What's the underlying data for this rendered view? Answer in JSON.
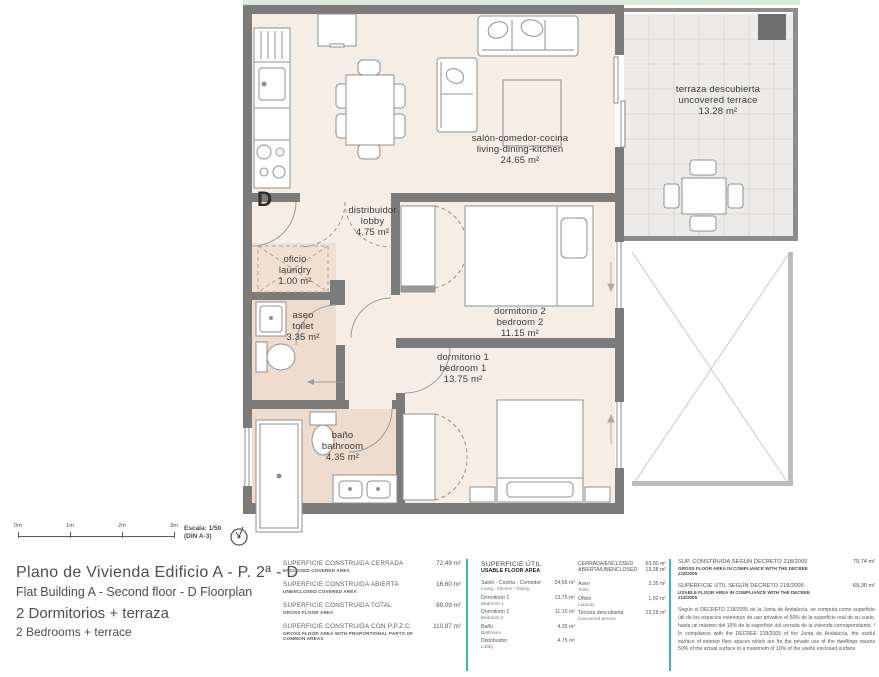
{
  "colors": {
    "accent_teal": "#45b2a6",
    "wall_gray": "#7b7b7b",
    "floor_cream": "#f6eee6",
    "wet_floor": "#f0e0d3",
    "terrace_gray": "#ecebe9"
  },
  "plan": {
    "unit_letter": "D",
    "rooms": [
      {
        "id": "living",
        "es": "salón-comedor-cocina",
        "en": "living-dining-kitchen",
        "area": "24.65 m²"
      },
      {
        "id": "terrace",
        "es": "terraza descubierta",
        "en": "uncovered terrace",
        "area": "13.28 m²"
      },
      {
        "id": "lobby",
        "es": "distribuidor",
        "en": "lobby",
        "area": "4.75 m²"
      },
      {
        "id": "laundry",
        "es": "oficio",
        "en": "laundry",
        "area": "1.00 m²"
      },
      {
        "id": "toilet",
        "es": "aseo",
        "en": "toilet",
        "area": "3.35 m²"
      },
      {
        "id": "bedroom2",
        "es": "dormitorio 2",
        "en": "bedroom 2",
        "area": "11.15 m²"
      },
      {
        "id": "bedroom1",
        "es": "dormitorio 1",
        "en": "bedroom 1",
        "area": "13.75 m²"
      },
      {
        "id": "bathroom",
        "es": "baño",
        "en": "bathroom",
        "area": "4.35 m²"
      }
    ]
  },
  "scalebar": {
    "ticks": [
      "0m",
      "1m",
      "2m",
      "3m"
    ],
    "scale": "Escala: 1/50",
    "sheet": "(DIN A-3)"
  },
  "title_block": {
    "es_line1": "Plano de Vivienda Edificio A - P. 2ª - D",
    "en_line1": "Flat Building A - Second floor - D  Floorplan",
    "es_line2": "2 Dormitorios + terraza",
    "en_line2": "2 Bedrooms + terrace"
  },
  "built_areas": {
    "rows": [
      {
        "es": "SUPERFICIE CONSTRUIDA CERRADA",
        "en": "ENCLOSED COVERED AREA",
        "value": "72,49 m²"
      },
      {
        "es": "SUPERFICIE CONSTRUIDA ABIERTA",
        "en": "UNENCLOSED COVERED AREA",
        "value": "16,60 m²"
      },
      {
        "es": "SUPERFICIE CONSTRUIDA TOTAL",
        "en": "GROSS FLOOR AREA",
        "value": "89,09 m²"
      },
      {
        "es": "SUPERFICIE CONSTRUIDA CON P.P.Z.C.",
        "en": "GROSS FLOOR AREA WITH PROPORTIONAL PARTS OF COMMON AREAS",
        "value": "110,87 m²"
      }
    ]
  },
  "usable_areas": {
    "title_es": "SUPERFICIE ÚTIL",
    "title_en": "USABLE FLOOR AREA",
    "rooms_left": [
      {
        "es": "Salón - Cocina - Comedor",
        "en": "Living - Kitchen - Dining",
        "value": "24,65 m²"
      },
      {
        "es": "Dormitorio 1",
        "en": "Bedroom 1",
        "value": "13,75 m²"
      },
      {
        "es": "Dormitorio 2",
        "en": "Bedroom 2",
        "value": "11,15 m²"
      },
      {
        "es": "Baño",
        "en": "Bathroom",
        "value": "4,35 m²"
      },
      {
        "es": "Distribuidor",
        "en": "Lobby",
        "value": "4,75 m²"
      }
    ],
    "summary": [
      {
        "label": "CERRADA/ENCLOSED",
        "value": "63,00 m²"
      },
      {
        "label": "ABIERTA/UNENCLOSED",
        "value": "13,28 m²"
      }
    ],
    "rooms_right": [
      {
        "es": "Aseo",
        "en": "Toilet",
        "value": "3,35 m²"
      },
      {
        "es": "Oficio",
        "en": "Laundry",
        "value": "1,00 m²"
      },
      {
        "es": "Terraza descubierta",
        "en": "Uncovered terrace",
        "value": "13,28 m²"
      }
    ]
  },
  "decree": {
    "rows": [
      {
        "es": "SUP. CONSTRUIDA SEGÚN DECRETO 218/2005",
        "en": "GROSS FLOOR AREA IN COMPLIANCE WITH THE DECREE 218/2005",
        "value": "79,74 m²"
      },
      {
        "es": "SUPERFICIE ÚTIL SEGÚN DECRETO 218/2005",
        "en": "USABLE FLOOR AREA IN COMPLIANCE WITH THE DECREE 218/2005",
        "value": "69,30 m²"
      }
    ],
    "note": "Según el DECRETO 218/2005 de la Junta de Andalucía, se computa como superficie útil de los espacios exteriores de uso privativo el 50% de la superficie real de su suelo, hasta un máximo del 10% de la superficie útil cerrada de la vivienda correspondiente. / In compliance with the DECREE 218/2005 of the Junta de Andalucía, the useful surface of exterior floor spaces which are for the private use of the dwellings means 50% of the actual surface to a maximum of 10% of the useful enclosed surface."
  }
}
